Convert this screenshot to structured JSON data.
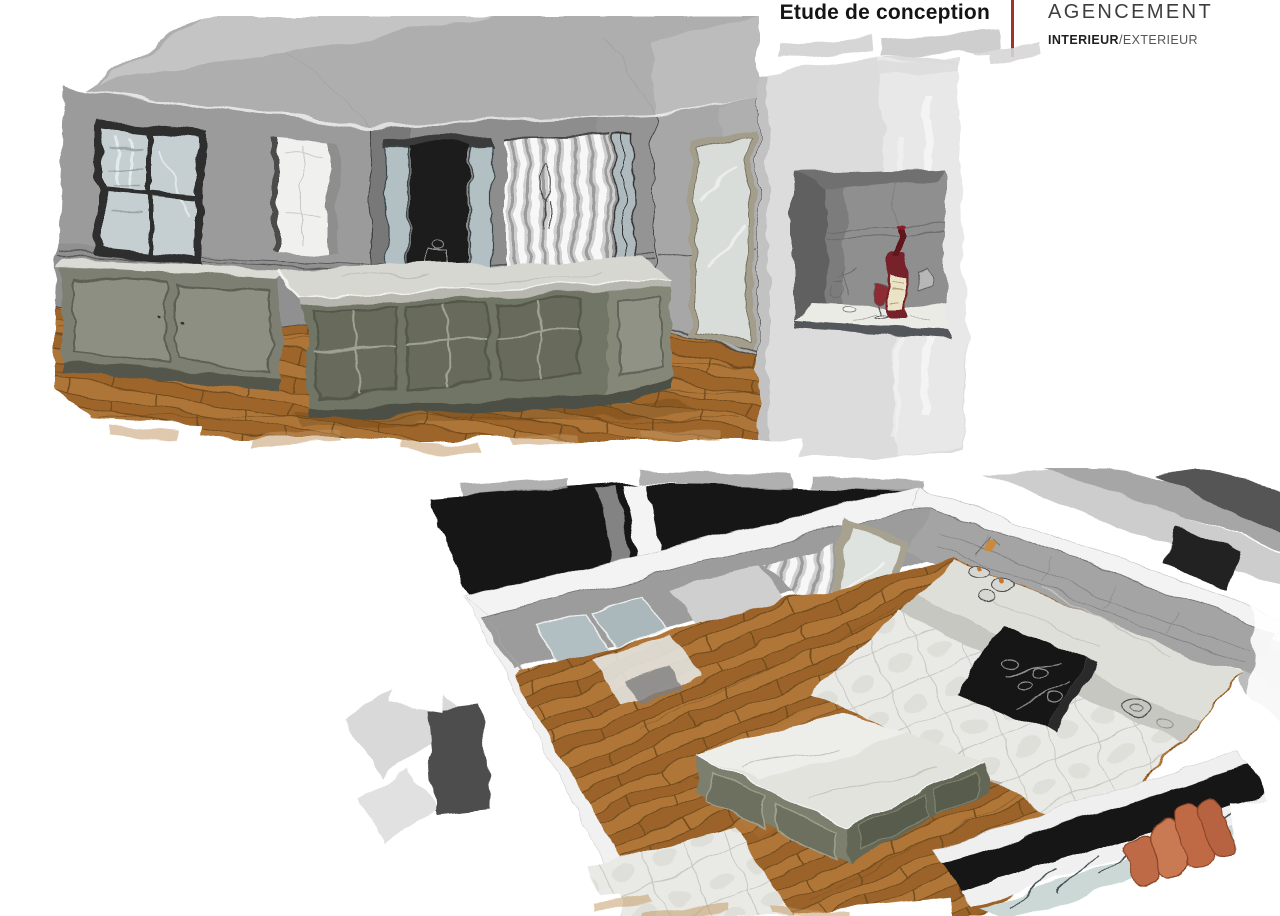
{
  "header": {
    "title": "Etude de conception",
    "brand": {
      "name": "AGENCEMENT",
      "tagline_bold": "INTERIEUR",
      "tagline_rest": "/EXTERIEUR"
    }
  },
  "palette": {
    "accent_red": "#9c342c",
    "page_bg": "#ffffff",
    "wall_gray": "#8d8d8d",
    "ceiling_gray": "#aeaeae",
    "floor_wood": "#a66c31",
    "marble_light": "#d8d8d3",
    "cabinet_sage": "#75786a",
    "curtain_stripe": "#9b9b9b",
    "exterior_dark": "#171717",
    "sofa_terracotta": "#c06a47",
    "wine_bottle_red": "#77232c"
  },
  "figures": {
    "top": {
      "alt": "Perspective sketch view of kitchen with central island, striped curtains and pass-through wall opening"
    },
    "bottom": {
      "alt": "Aerial sketch view of the kitchen plan with island, range counter and wood floor"
    }
  }
}
